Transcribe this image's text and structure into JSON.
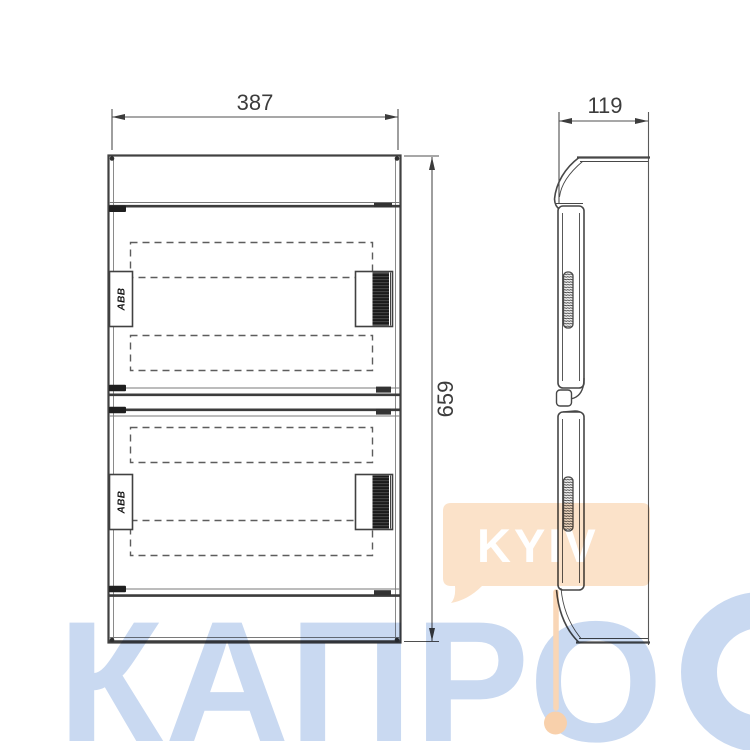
{
  "drawing": {
    "title": "ABB enclosure dimensional drawing",
    "front_view": {
      "width_label": "387",
      "height_label": "659",
      "brand_label": "ABB"
    },
    "side_view": {
      "depth_label": "119"
    },
    "line_color": "#414141"
  },
  "watermark": {
    "kyiv_label": "KYIV",
    "kapro_label": "КАПРО",
    "blue_color": "#c9d9f1",
    "peach_color": "#fbe2c9",
    "peach_deep_color": "#f8d0ab"
  }
}
